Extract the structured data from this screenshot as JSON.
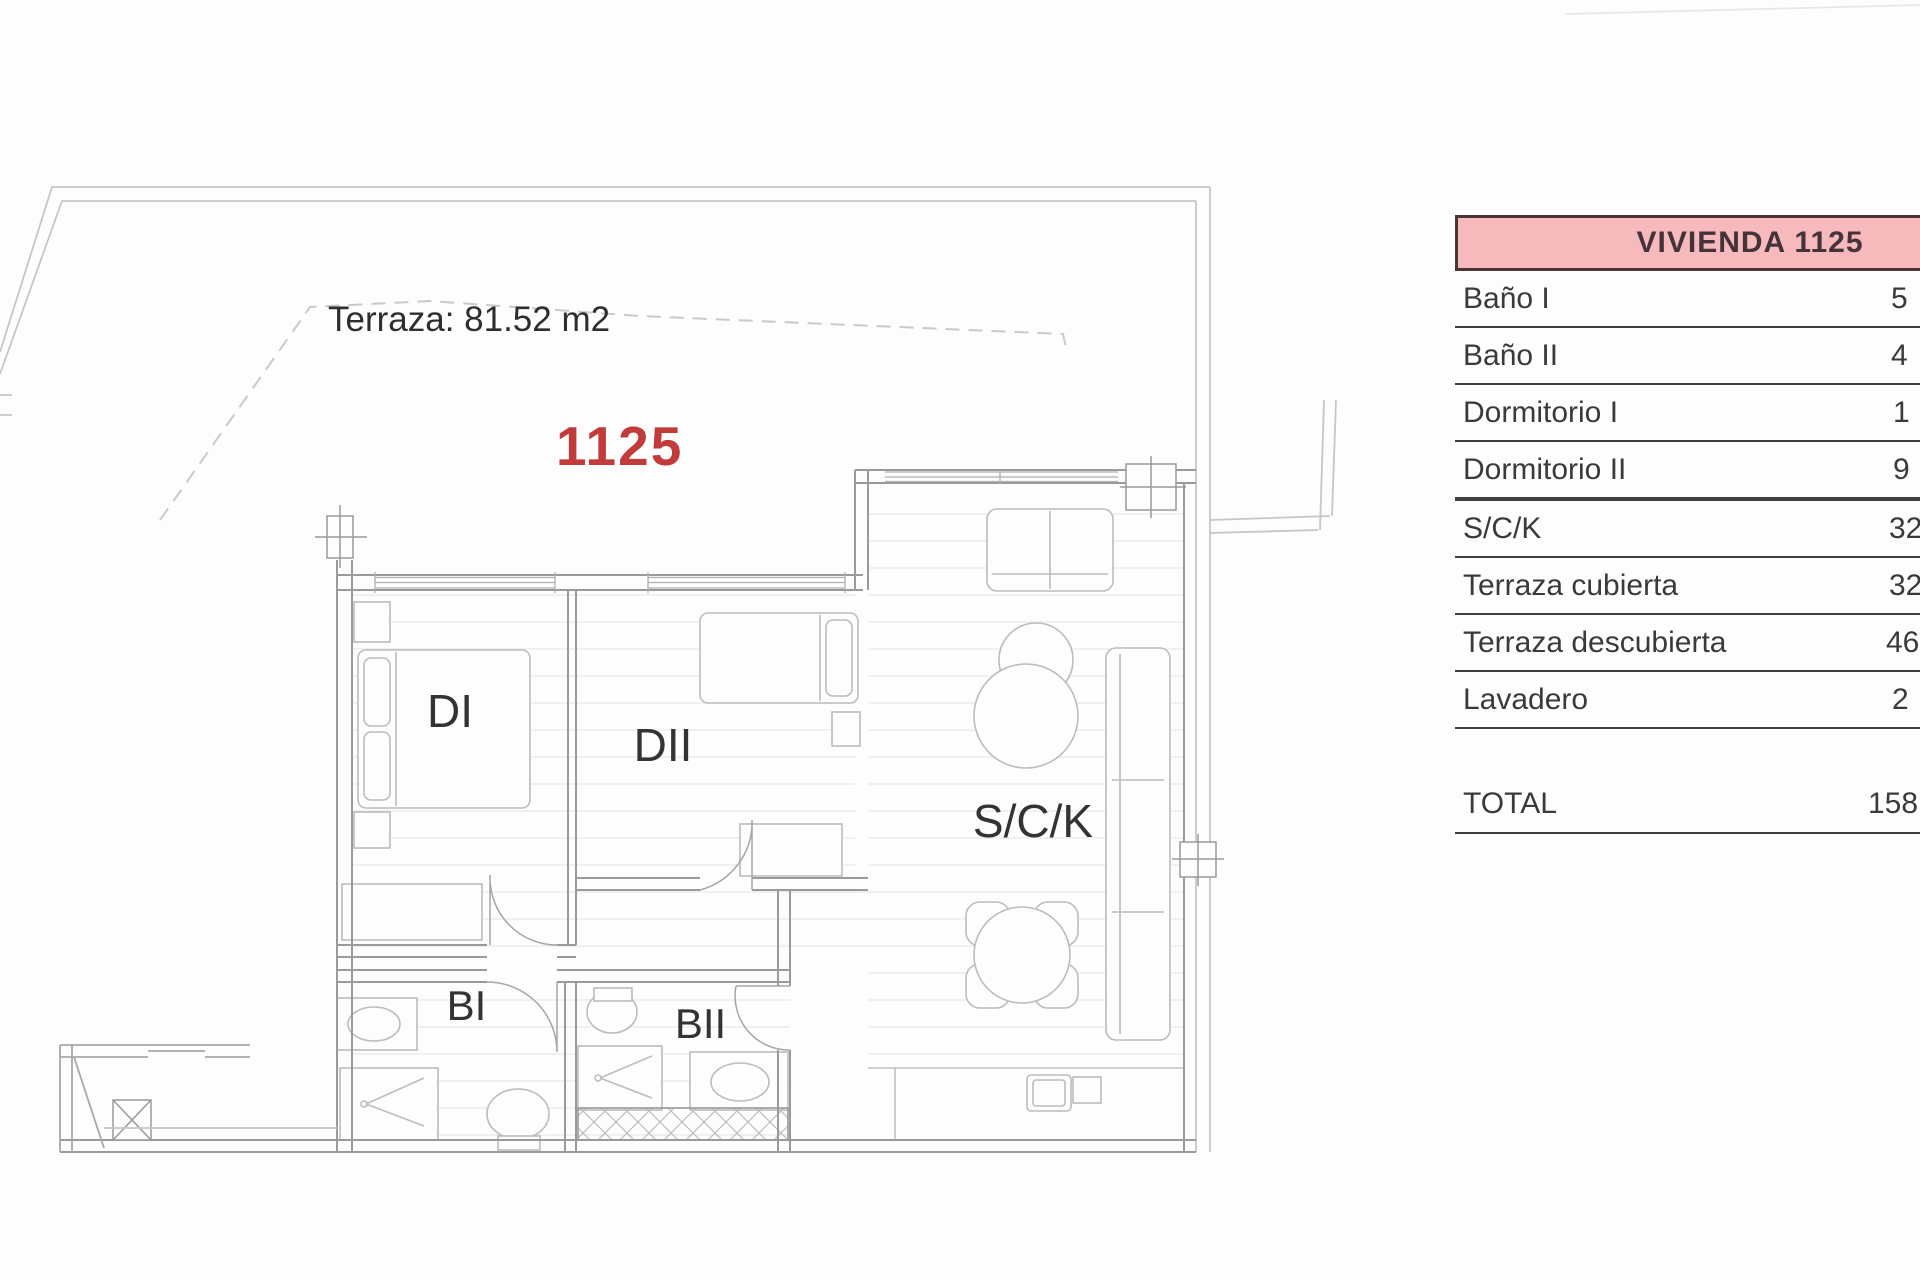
{
  "plan": {
    "unit_number": "1125",
    "terrace_label": "Terraza: 81.52 m2",
    "accent_red": "#c23b3b",
    "rooms": {
      "dormitorio1": "DI",
      "dormitorio2": "DII",
      "salon_cocina": "S/C/K",
      "bano1": "BI",
      "bano2": "BII"
    }
  },
  "table": {
    "header": "VIVIENDA 1125",
    "header_bg": "#f6b9bc",
    "rows": [
      {
        "label": "Baño I",
        "value": "5"
      },
      {
        "label": "Baño II",
        "value": "4"
      },
      {
        "label": "Dormitorio I",
        "value": "1"
      },
      {
        "label": "Dormitorio II",
        "value": "9"
      },
      {
        "label": "S/C/K",
        "value": "32"
      },
      {
        "label": "Terraza cubierta",
        "value": "32"
      },
      {
        "label": "Terraza descubierta",
        "value": "46"
      },
      {
        "label": "Lavadero",
        "value": "2"
      }
    ],
    "total": {
      "label": "TOTAL",
      "value": "158"
    }
  }
}
